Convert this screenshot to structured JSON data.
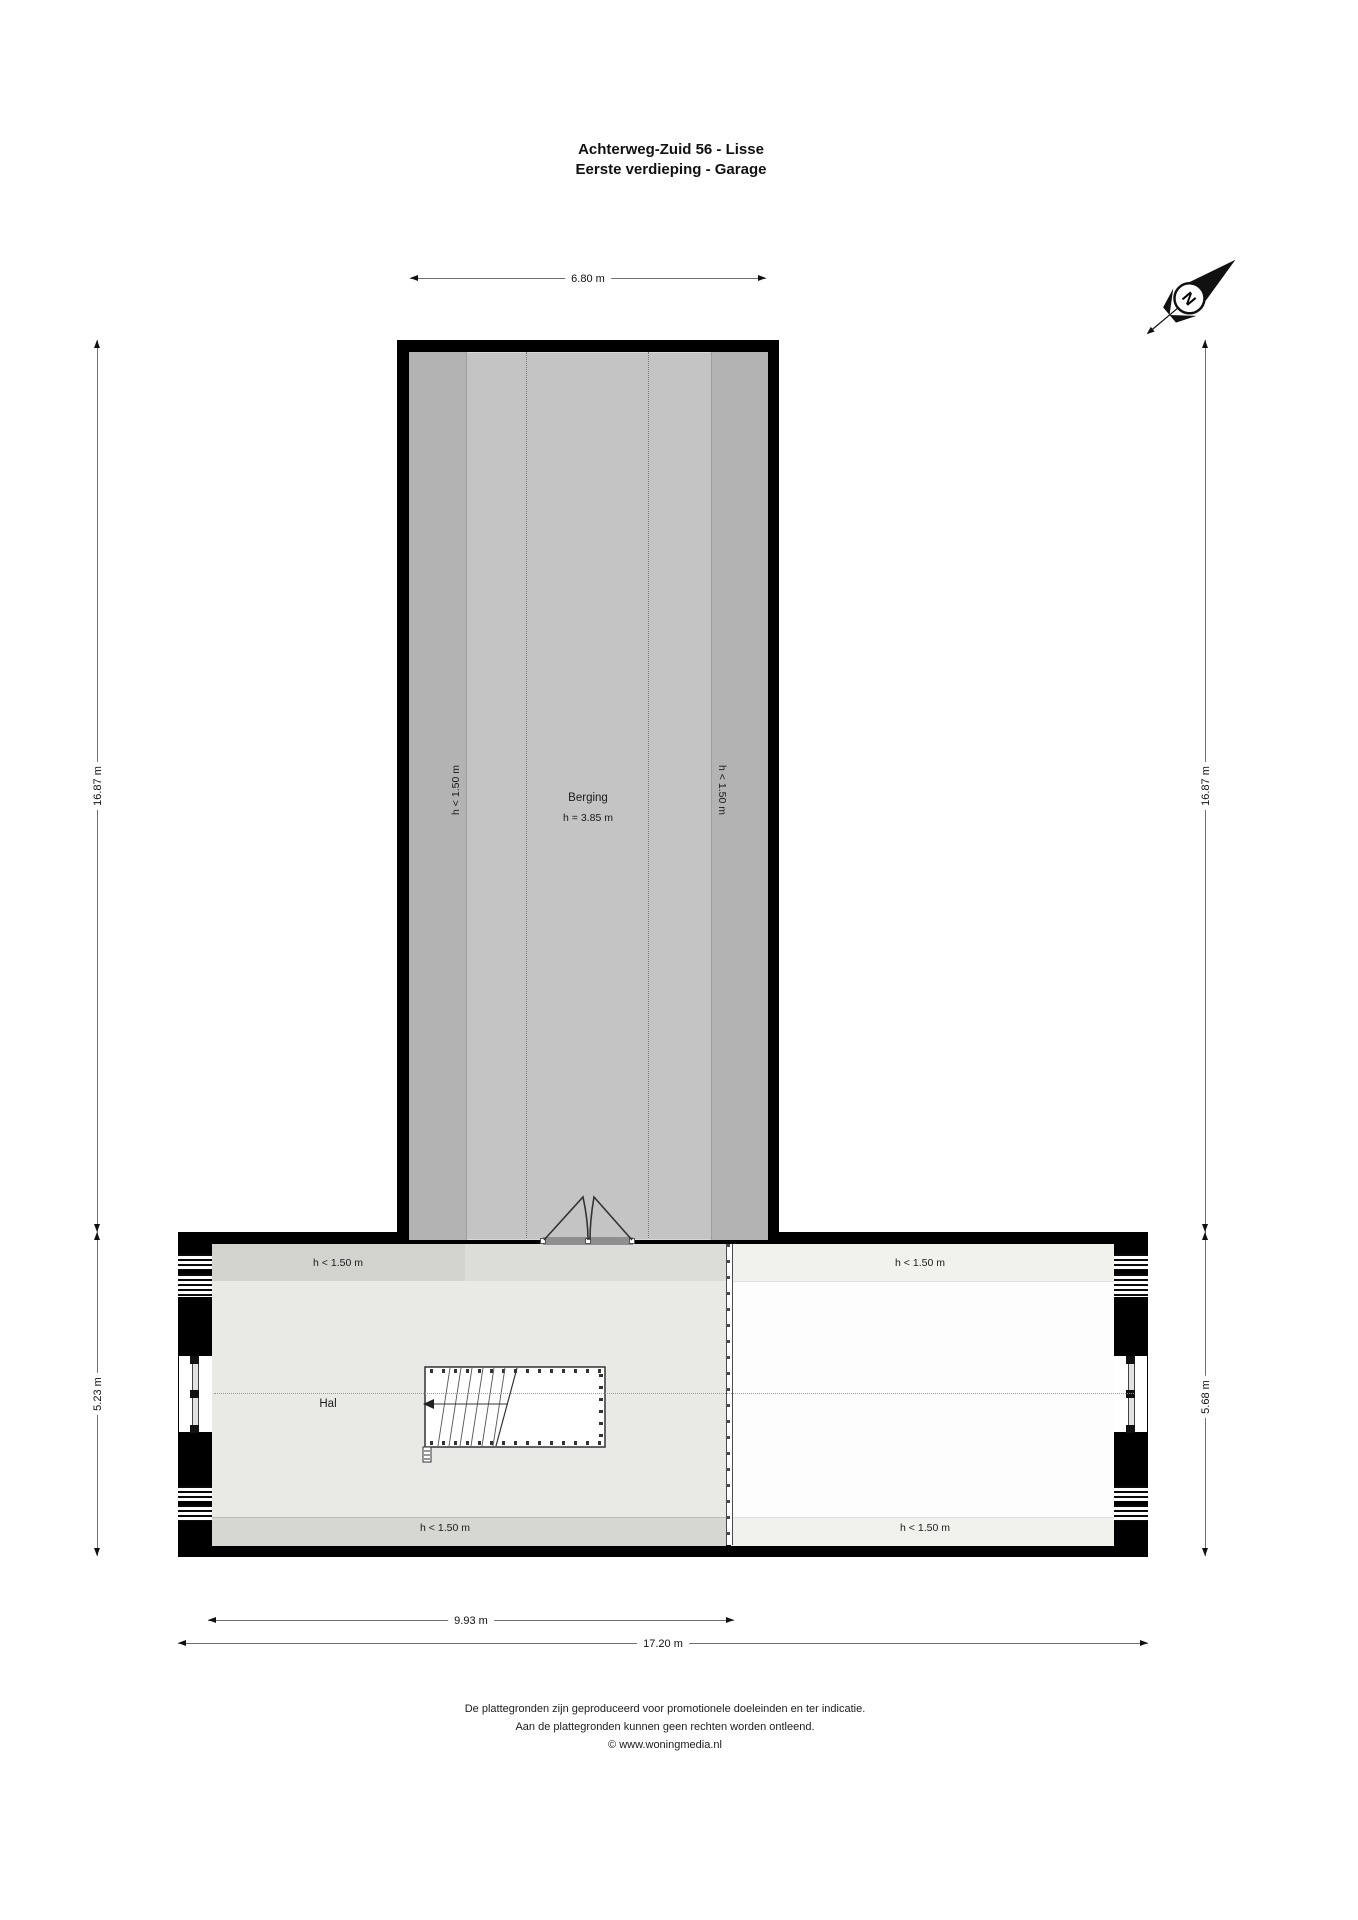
{
  "title": {
    "line1": "Achterweg-Zuid 56 - Lisse",
    "line2": "Eerste verdieping - Garage"
  },
  "compass": {
    "north": "N"
  },
  "dims": {
    "top": "6.80 m",
    "left_upper": "16.87 m",
    "left_lower": "5.23 m",
    "right_upper": "16.87 m",
    "right_lower": "5.68 m",
    "bottom_left": "9.93 m",
    "bottom_full": "17.20 m"
  },
  "berging": {
    "name": "Berging",
    "clear_height": "h = 3.85 m",
    "low_left": "h < 1.50 m",
    "low_right": "h < 1.50 m"
  },
  "hal": {
    "name": "Hal",
    "low_top": "h < 1.50 m",
    "low_bottom": "h < 1.50 m"
  },
  "attic_right": {
    "low_top": "h < 1.50 m",
    "low_bottom": "h < 1.50 m"
  },
  "footer": {
    "line1": "De plattegronden zijn geproduceerd voor promotionele doeleinden en ter indicatie.",
    "line2": "Aan de plattegronden kunnen geen rechten worden ontleend.",
    "line3": "© www.woningmedia.nl"
  },
  "colors": {
    "wall": "#000000",
    "berging_floor": "#c4c4c4",
    "berging_low_strip": "#b3b3b3",
    "hal_floor": "#e9e9e5",
    "hal_low_strip": "#d6d6d2",
    "right_floor": "#fdfdfd",
    "right_low_strip": "#f1f1ee"
  }
}
